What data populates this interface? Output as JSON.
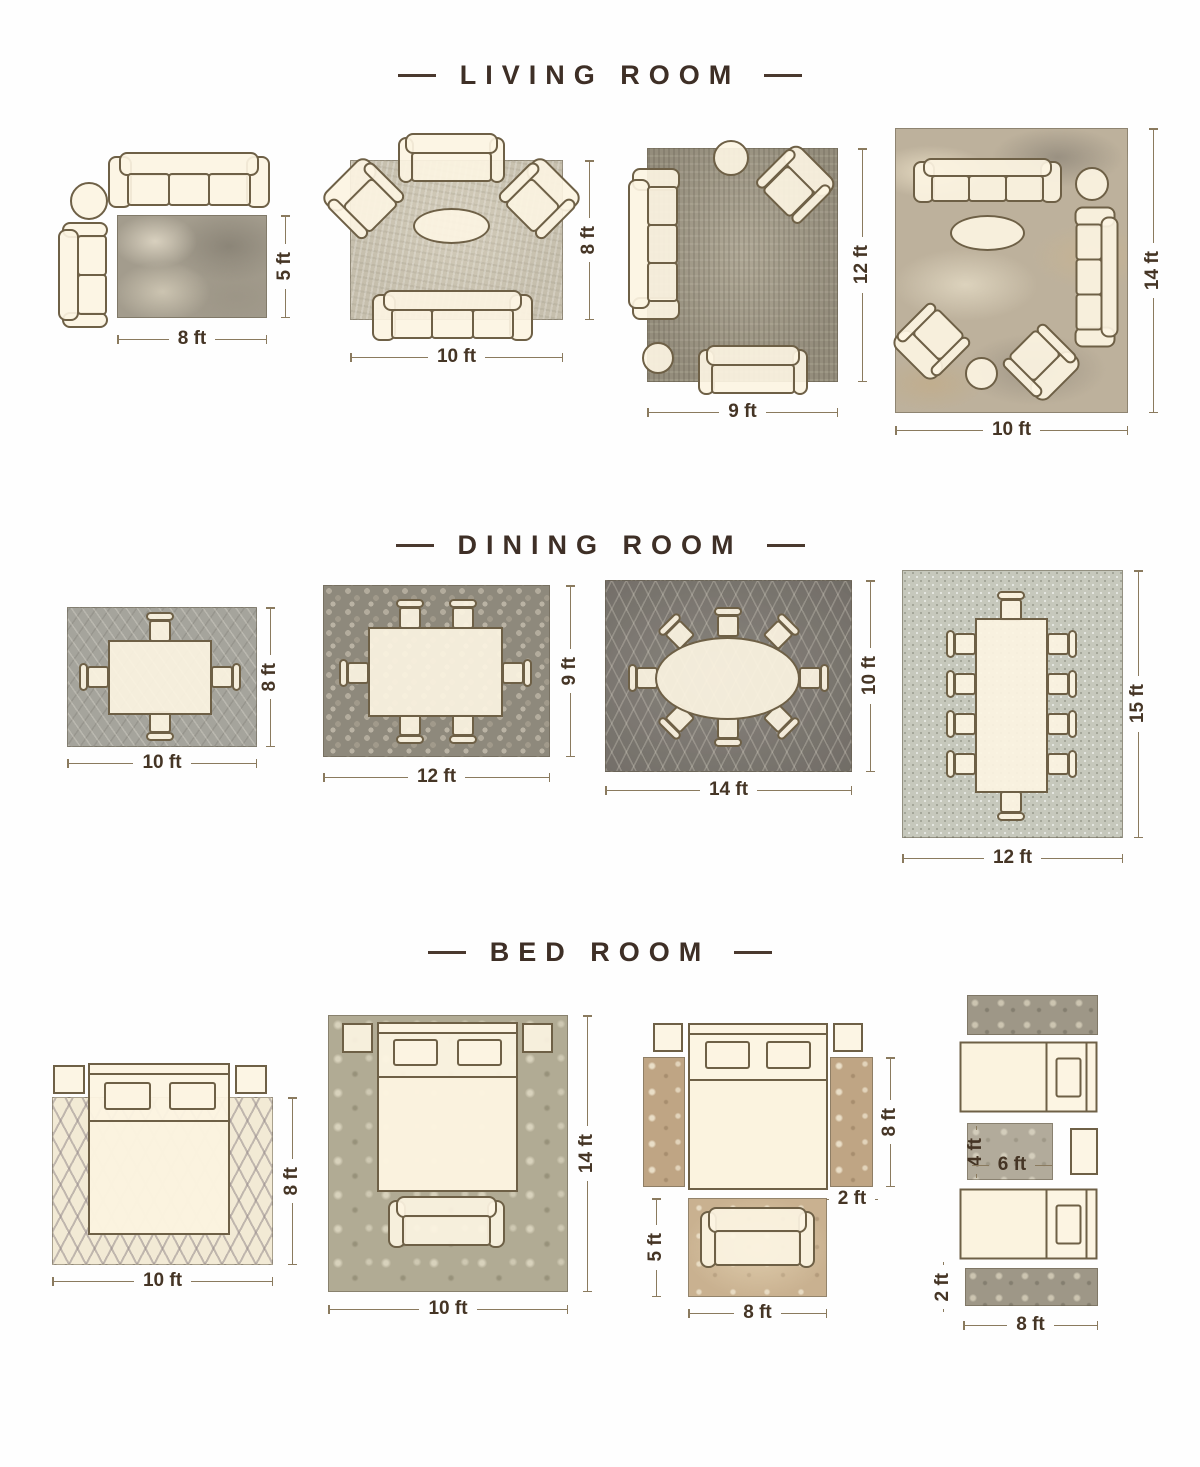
{
  "colors": {
    "background": "#fefefe",
    "title_text": "#3e2f26",
    "dimension_text": "#453525",
    "dimension_line": "#8a7a5e",
    "furniture_fill": "#fcf4e2",
    "furniture_outline": "#6e6046"
  },
  "sections": {
    "living": {
      "title": "LIVING ROOM",
      "layouts": {
        "l1": {
          "w": "8 ft",
          "h": "5 ft"
        },
        "l2": {
          "w": "10 ft",
          "h": "8 ft"
        },
        "l3": {
          "w": "9 ft",
          "h": "12 ft"
        },
        "l4": {
          "w": "10 ft",
          "h": "14 ft"
        }
      }
    },
    "dining": {
      "title": "DINING ROOM",
      "layouts": {
        "d1": {
          "w": "10 ft",
          "h": "8 ft"
        },
        "d2": {
          "w": "12 ft",
          "h": "9 ft"
        },
        "d3": {
          "w": "14 ft",
          "h": "10 ft"
        },
        "d4": {
          "w": "12 ft",
          "h": "15 ft"
        }
      }
    },
    "bedroom": {
      "title": "BED ROOM",
      "layouts": {
        "b1": {
          "w": "10 ft",
          "h": "8 ft"
        },
        "b2": {
          "w": "10 ft",
          "h": "14 ft"
        },
        "b3": {
          "w": "8 ft",
          "h": "5 ft",
          "runner_h": "8 ft",
          "runner_w": "2 ft"
        },
        "b4": {
          "w": "8 ft",
          "runner_w": "2 ft",
          "accent_w": "6 ft",
          "accent_h": "4 ft"
        }
      }
    }
  }
}
